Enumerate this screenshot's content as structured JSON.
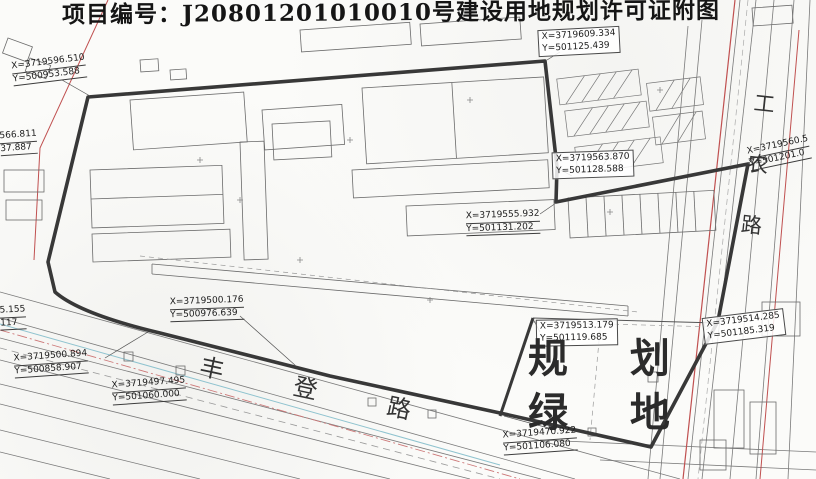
{
  "title": "项目编号：J20801201010010号建设用地规划许可证附图",
  "map": {
    "points": [
      {
        "x": "X=3719596.510",
        "y": "Y=500953.588"
      },
      {
        "x": "X=3719609.334",
        "y": "Y=501125.439"
      },
      {
        "x": "X=3719563.870",
        "y": "Y=501128.588"
      },
      {
        "x": "X=3719560.5",
        "y": "Y=501201.0"
      },
      {
        "x": "X=3719555.932",
        "y": "Y=501131.202"
      },
      {
        "x": "X=3719500.176",
        "y": "Y=500976.639"
      },
      {
        "x": "566.811",
        "y": "37.887"
      },
      {
        "x": "5.155",
        "y": "117"
      },
      {
        "x": "X=3719500.894",
        "y": "Y=500858.907"
      },
      {
        "x": "X=3719497.495",
        "y": "Y=501060.000"
      },
      {
        "x": "X=3719513.179",
        "y": "Y=501119.685"
      },
      {
        "x": "X=3719514.285",
        "y": "Y=501185.319"
      },
      {
        "x": "X=3719470.922",
        "y": "Y=501106.080"
      }
    ],
    "green_space": {
      "line1": "规 划",
      "line2": "绿 地"
    },
    "roads": {
      "fengdeng": "丰 登 路",
      "gongnong": "工农路"
    }
  },
  "colors": {
    "boundary": "#383838",
    "road_centerline_red": "#c05050",
    "utility_cyan": "#8fc3cf",
    "parcel_gray": "#6b6b6b"
  }
}
